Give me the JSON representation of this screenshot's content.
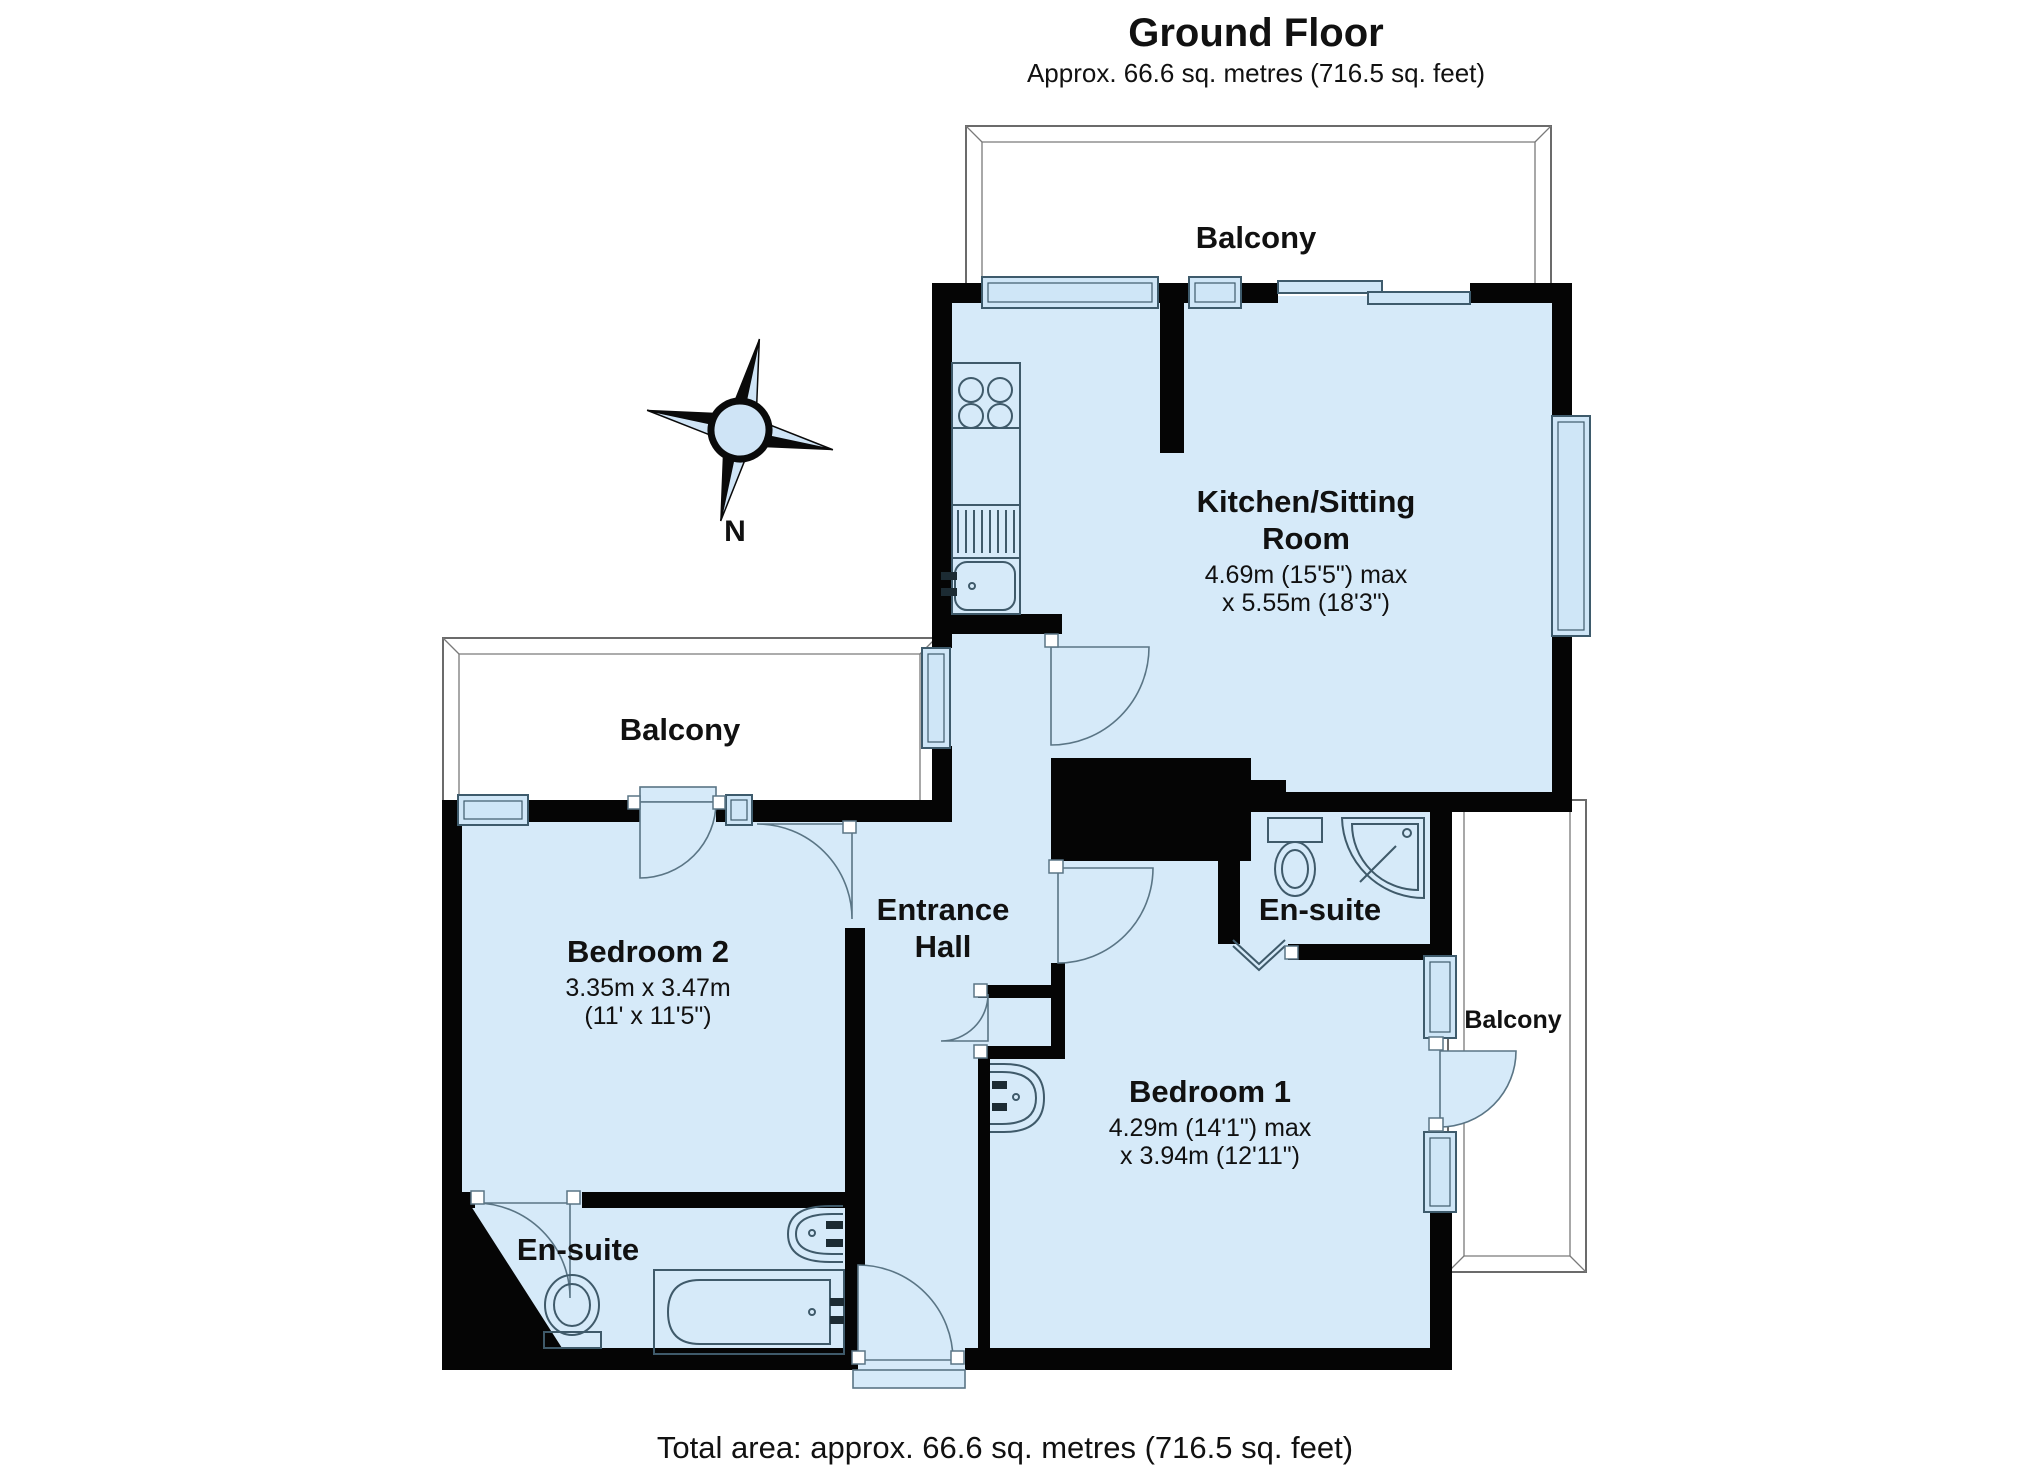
{
  "page": {
    "background": "#ffffff"
  },
  "header": {
    "title": "Ground Floor",
    "subtitle": "Approx. 66.6 sq. metres (716.5 sq. feet)"
  },
  "footer": {
    "total_area_label": "Total area: approx. 66.6 sq. metres (716.5 sq. feet)"
  },
  "compass": {
    "north_label": "N"
  },
  "colors": {
    "room_fill": "#d6eaf9",
    "wall": "#050505",
    "balcony_outline": "#6b6b6b",
    "fixture_outline": "#3f5a6a",
    "text": "#111111"
  },
  "rooms": {
    "balcony_top": {
      "label": "Balcony"
    },
    "balcony_left": {
      "label": "Balcony"
    },
    "balcony_right": {
      "label": "Balcony"
    },
    "kitchen_sitting_room": {
      "name_line1": "Kitchen/Sitting",
      "name_line2": "Room",
      "dims_line1": "4.69m (15'5\") max",
      "dims_line2": "x 5.55m (18'3\")"
    },
    "bedroom_2": {
      "name": "Bedroom 2",
      "dims_line1": "3.35m x 3.47m",
      "dims_line2": "(11' x 11'5\")"
    },
    "bedroom_1": {
      "name": "Bedroom 1",
      "dims_line1": "4.29m (14'1\") max",
      "dims_line2": "x 3.94m (12'11\")"
    },
    "entrance_hall": {
      "name_line1": "Entrance",
      "name_line2": "Hall"
    },
    "ensuite_bedroom2": {
      "name": "En-suite"
    },
    "ensuite_bedroom1": {
      "name": "En-suite"
    }
  },
  "fixtures": [
    "hob",
    "sink",
    "draining-board",
    "kitchen-counter",
    "toilet",
    "corner-shower",
    "basin",
    "bath"
  ]
}
